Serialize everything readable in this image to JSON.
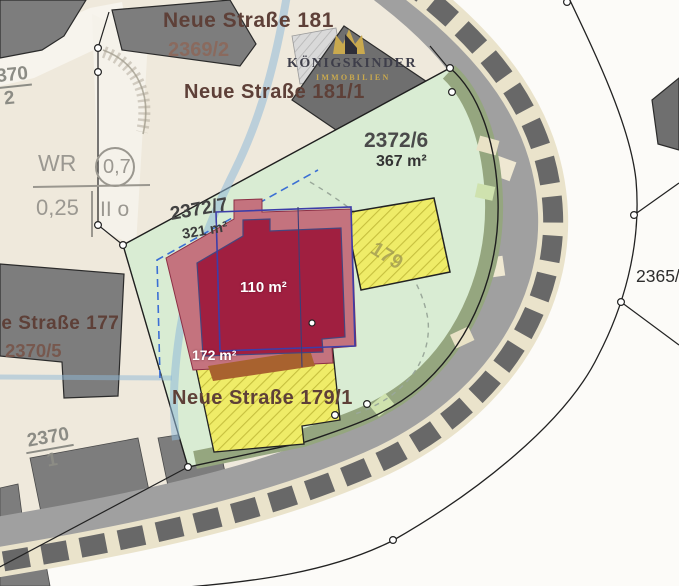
{
  "map": {
    "title_note": "site plan (Lageplan)",
    "streets": {
      "neue_strasse_181": "Neue Straße 181",
      "neue_strasse_181_1": "Neue Straße 181/1",
      "neue_strasse_177": "Neue Straße 177",
      "neue_strasse_179_1": "Neue Straße 179/1"
    },
    "parcels": {
      "p2369_2": "2369/2",
      "p2372_6": "2372/6",
      "p2372_6_area": "367 m²",
      "p2372_7": "2372/7",
      "p2372_7_area": "321 m²",
      "p2370_5": "2370/5",
      "p2370_1_num": "2370",
      "p2370_1_den": "1",
      "p2370_2_num": "2370",
      "p2370_2_den": "2",
      "p2365": "2365/"
    },
    "buildings": {
      "main_house_area": "110 m²",
      "footprint_area": "172 m²",
      "house_179": "179"
    },
    "zoning": {
      "district": "WR",
      "value_top": "0,7",
      "value_bottom": "0,25",
      "storeys": "II o"
    },
    "logo": {
      "name": "KÖNIGSKINDER",
      "subtitle": "IMMOBILIEN"
    },
    "colors": {
      "parcel_green": "#d9ecd3",
      "hedge_green": "#95a67f",
      "building_red_core": "#a01f40",
      "building_red_roof": "#c4737e",
      "building_yellow": "#efec68",
      "building_gray": "#7d7d7d",
      "outline_blue": "#3d3da8",
      "water_blue": "#8fb9d8",
      "paper_cream": "#efe9dc",
      "logo_gold": "#c9a94e",
      "street_text": "#5e4038"
    }
  }
}
